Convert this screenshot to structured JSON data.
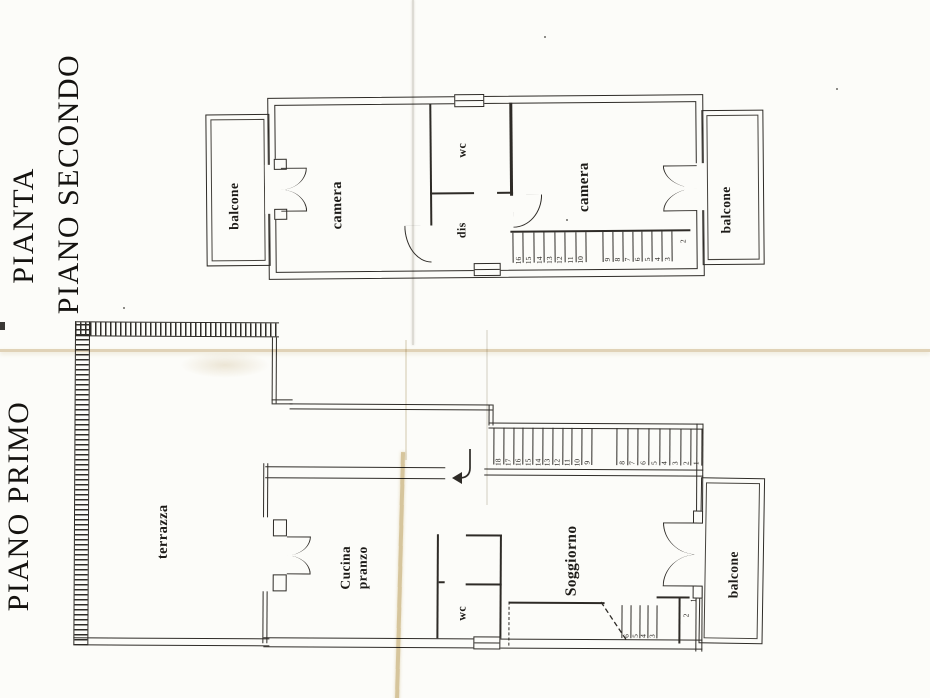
{
  "titles": {
    "pianta": "PIANTA",
    "piano_secondo": "PIANO SECONDO",
    "piano_primo": "PIANO PRIMO"
  },
  "floor2": {
    "rooms": {
      "balcone_left": "balcone",
      "camera_left": "camera",
      "wc": "wc",
      "dis": "dis",
      "camera_right": "camera",
      "balcone_right": "balcone"
    },
    "stairs": {
      "group_a": [
        "16",
        "15",
        "14",
        "13",
        "12",
        "11",
        "10"
      ],
      "group_b": [
        "9",
        "8",
        "7",
        "6",
        "5",
        "4",
        "3"
      ],
      "landing": "2"
    }
  },
  "floor1": {
    "rooms": {
      "terrazza": "terrazza",
      "cucina_line1": "Cucina",
      "cucina_line2": "pranzo",
      "wc": "wc",
      "soggiorno": "Soggiorno",
      "balcone_right": "balcone"
    },
    "stairs_main": {
      "group_a": [
        "18",
        "17",
        "16",
        "15",
        "14",
        "13",
        "12",
        "11",
        "10",
        "9"
      ],
      "group_b": [
        "8",
        "7",
        "6",
        "5",
        "4",
        "3",
        "2",
        "1"
      ]
    },
    "stairs_lower": {
      "treads": [
        "6",
        "5",
        "4",
        "3"
      ],
      "step_two": "2",
      "step_one": "1"
    }
  }
}
